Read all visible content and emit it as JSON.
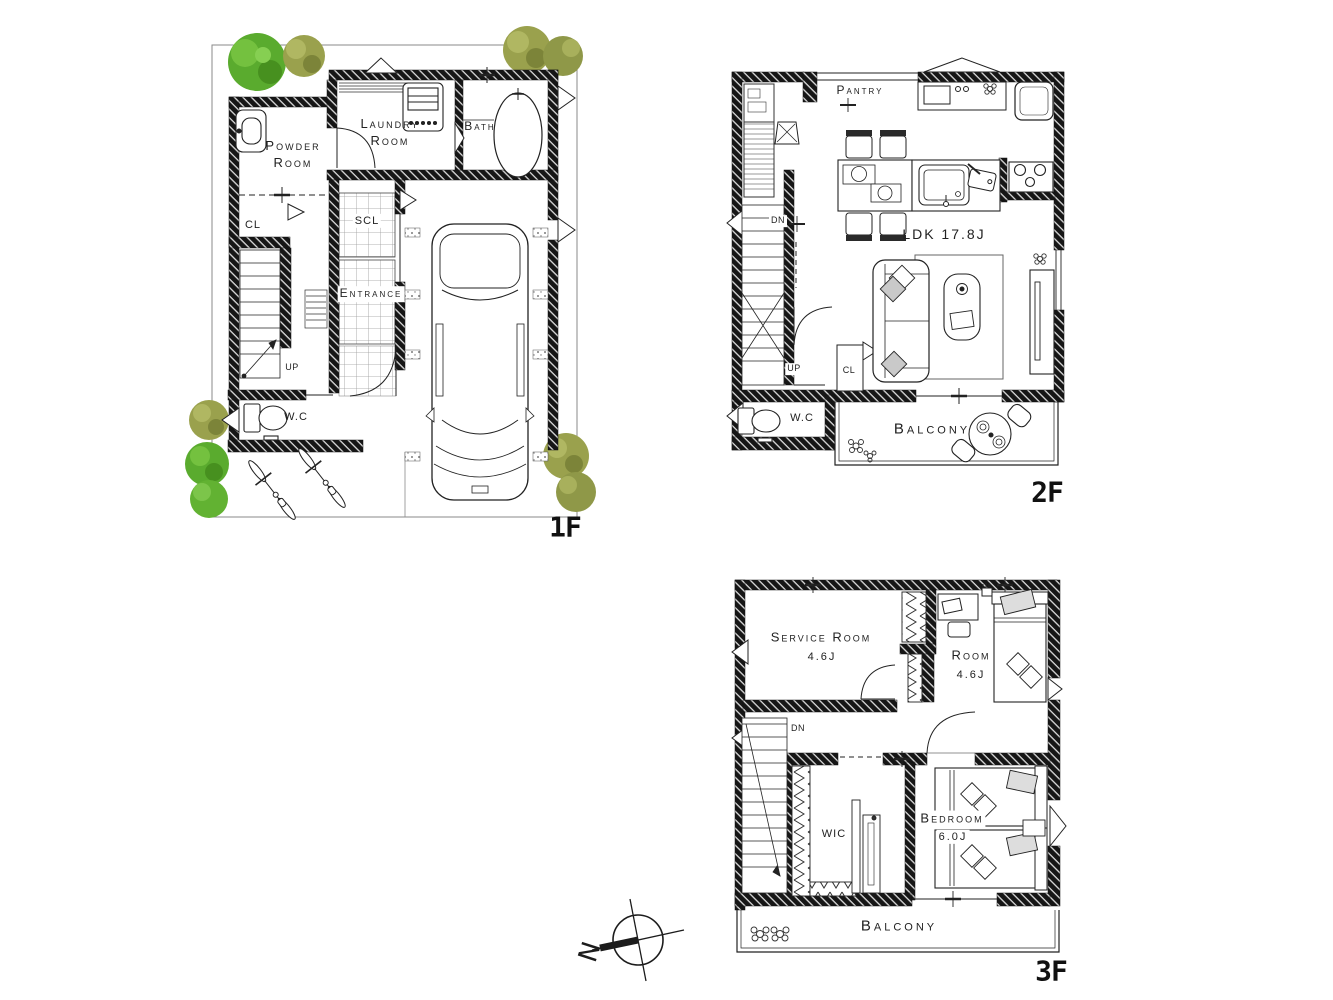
{
  "plan": {
    "compass_label": "N",
    "floor1": {
      "tag": "1F",
      "labels": {
        "powder_room": "Powder Room",
        "laundry_room": "Laundry Room",
        "bath": "Bath",
        "cl": "CL",
        "scl": "SCL",
        "entrance": "Entrance",
        "up": "UP",
        "wc": "W.C"
      }
    },
    "floor2": {
      "tag": "2F",
      "labels": {
        "pantry": "Pantry",
        "ldk": "LDK 17.8J",
        "dn": "DN",
        "up": "UP",
        "cl": "CL",
        "wc": "W.C",
        "balcony": "Balcony"
      }
    },
    "floor3": {
      "tag": "3F",
      "labels": {
        "service_room": "Service Room",
        "service_room_area": "4.6J",
        "room": "Room",
        "room_area": "4.6J",
        "dn": "DN",
        "wic": "WIC",
        "bedroom": "Bedroom",
        "bedroom_area": "6.0J",
        "balcony": "Balcony"
      }
    },
    "colors": {
      "line": "#1c1c1c",
      "tree_green": "#5aab2e",
      "tree_olive": "#9aa14d",
      "cushion_gray": "#c9c9c9"
    }
  }
}
